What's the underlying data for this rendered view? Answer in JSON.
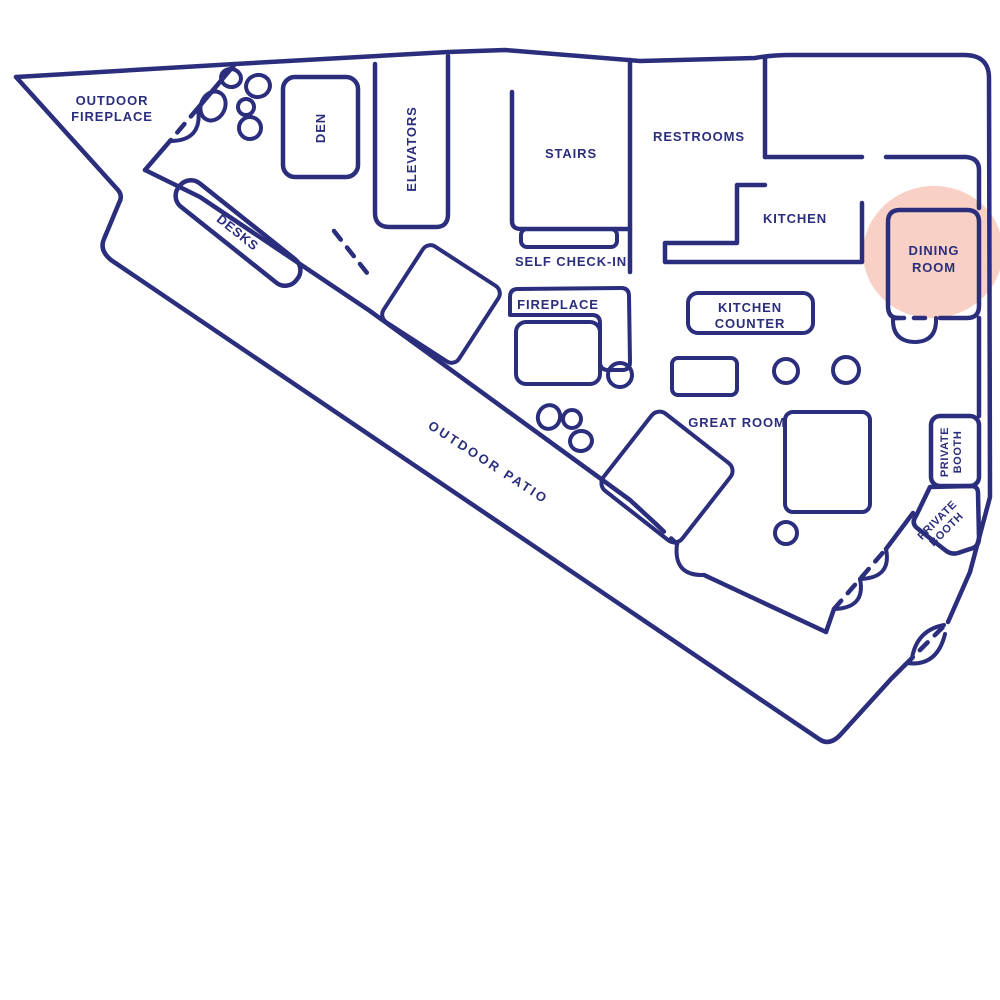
{
  "title": "Office floor plan",
  "colors": {
    "line": "#2b2e7d",
    "highlight": "#f8d0c6",
    "background": "#ffffff"
  },
  "highlighted_room": "DINING ROOM",
  "rooms": {
    "outdoor_fireplace": {
      "label": "OUTDOOR",
      "label2": "FIREPLACE"
    },
    "den": {
      "label": "DEN"
    },
    "elevators": {
      "label": "ELEVATORS"
    },
    "stairs": {
      "label": "STAIRS"
    },
    "self_check_in": {
      "label": "SELF CHECK-IN"
    },
    "restrooms": {
      "label": "RESTROOMS"
    },
    "kitchen": {
      "label": "KITCHEN"
    },
    "dining_room": {
      "label": "DINING",
      "label2": "ROOM",
      "highlighted": true
    },
    "kitchen_counter": {
      "label": "KITCHEN",
      "label2": "COUNTER"
    },
    "fireplace": {
      "label": "FIREPLACE"
    },
    "great_room": {
      "label": "GREAT ROOM"
    },
    "desks": {
      "label": "DESKS"
    },
    "outdoor_patio": {
      "label": "OUTDOOR PATIO"
    },
    "private_booth_upper": {
      "label": "PRIVATE",
      "label2": "BOOTH"
    },
    "private_booth_lower": {
      "label": "PRIVATE",
      "label2": "BOOTH"
    }
  }
}
